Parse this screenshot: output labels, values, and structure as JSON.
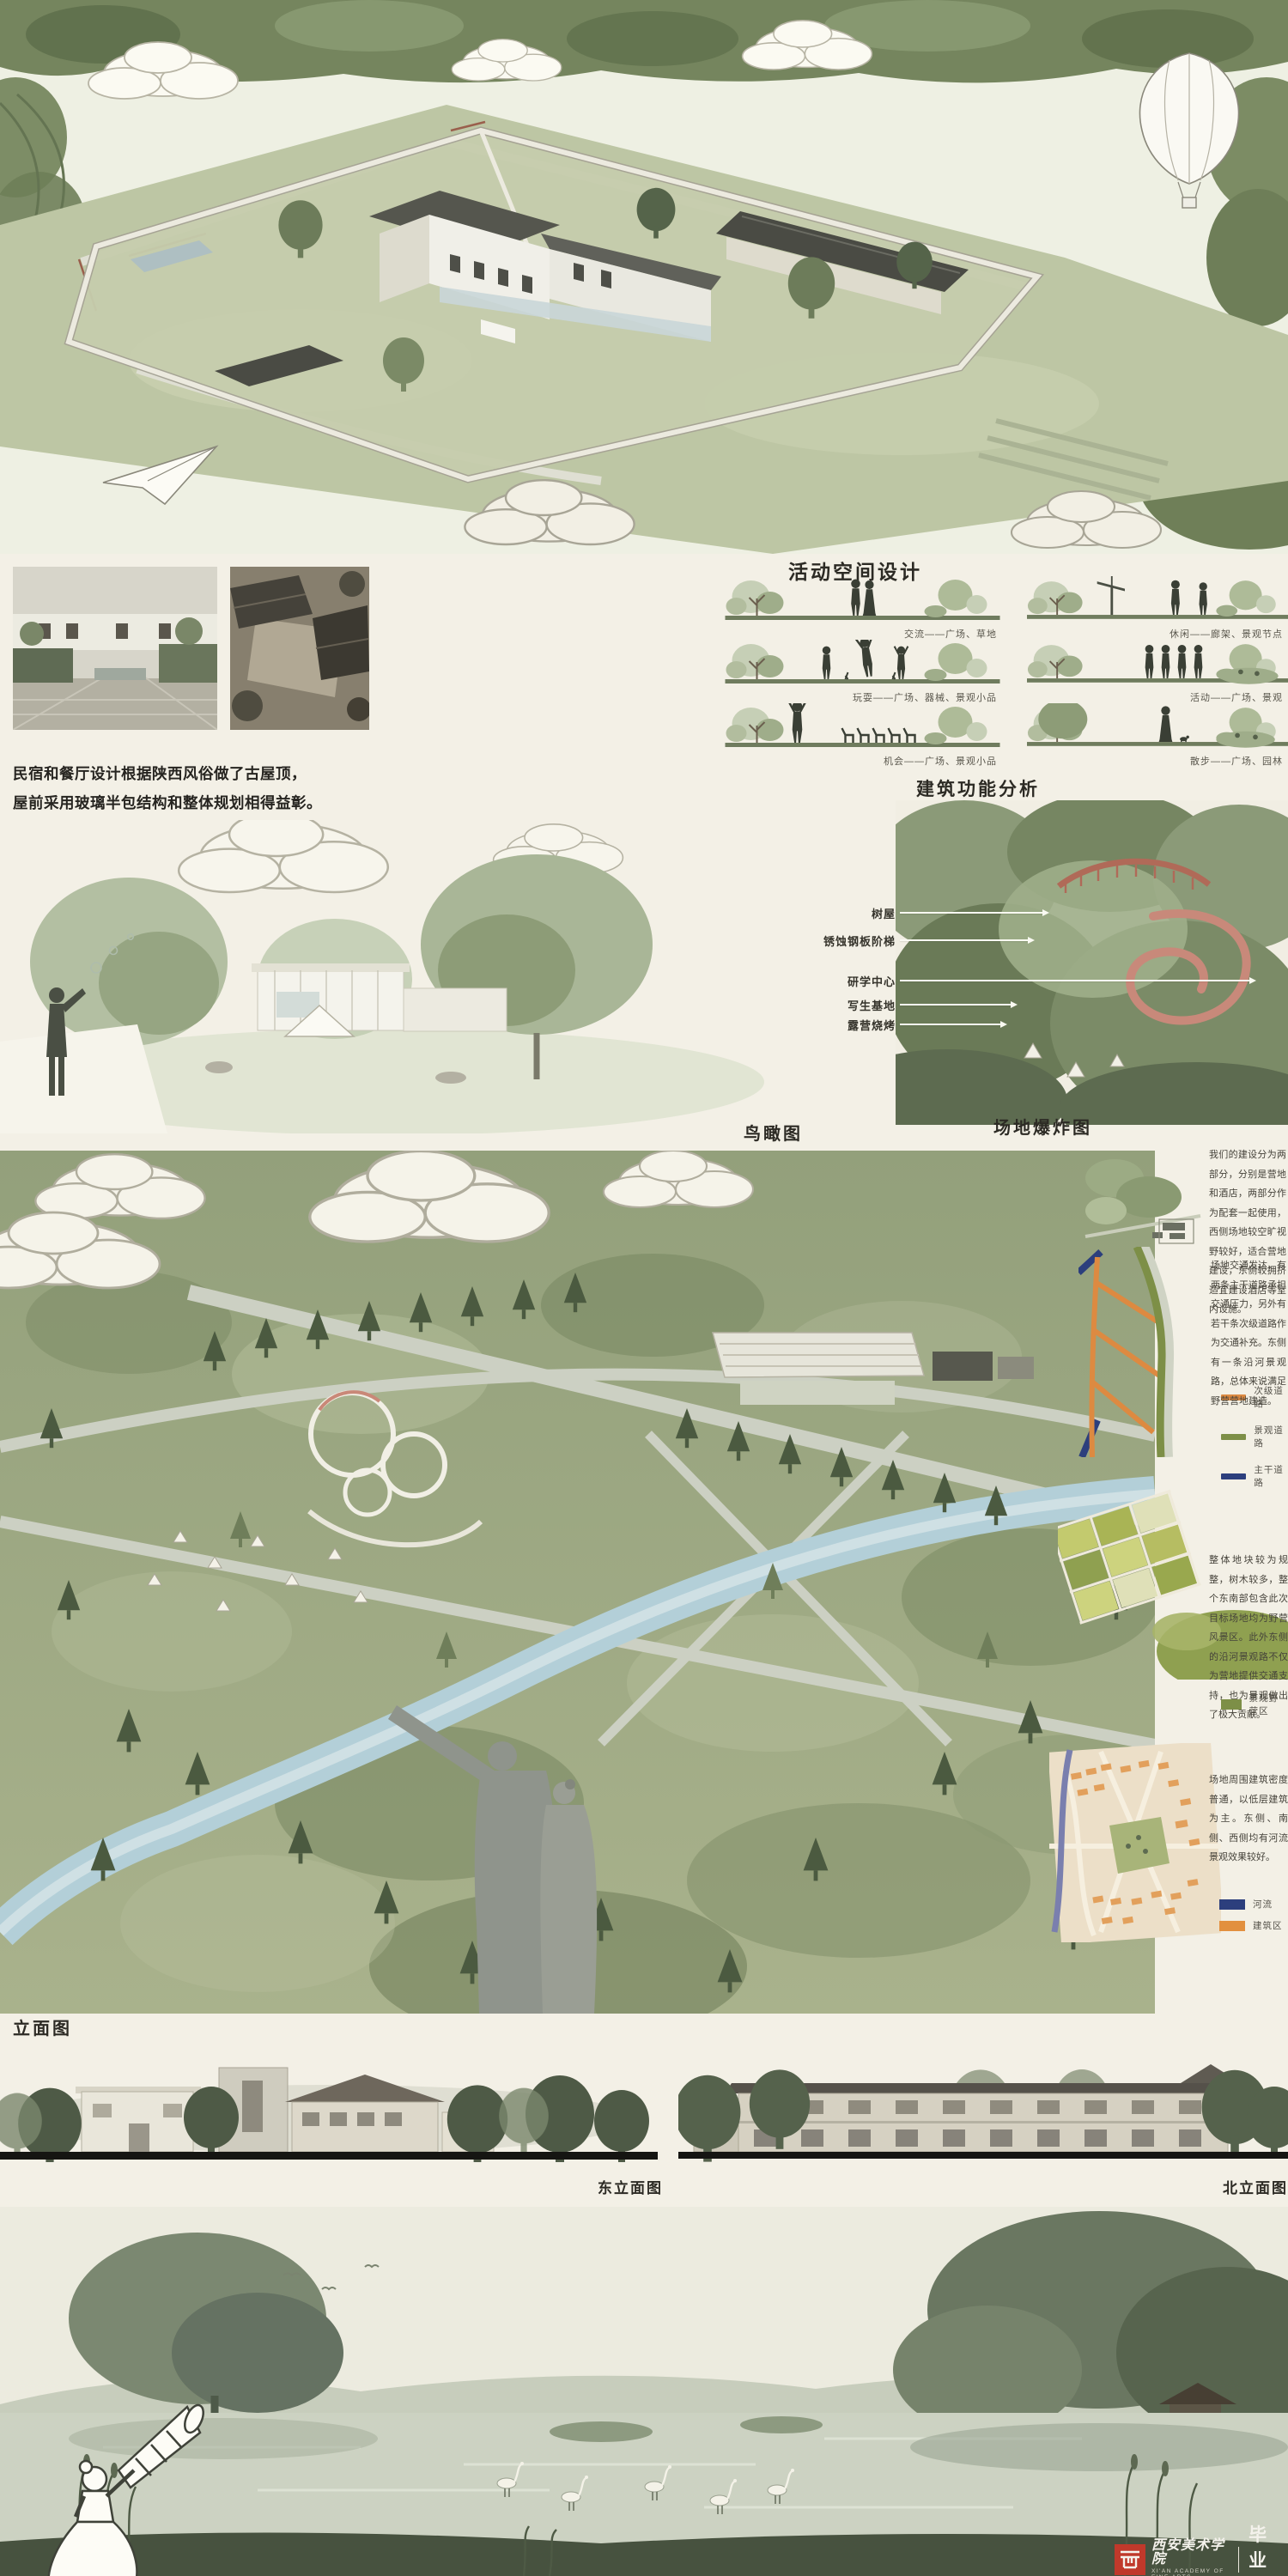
{
  "meta": {
    "page_bg": "#f3f0e6",
    "ground_bar_color": "#151512",
    "leader_line_color": "#fafaf2"
  },
  "intro": {
    "line1": "民宿和餐厅设计根据陕西风俗做了古屋顶，",
    "line2": "屋前采用玻璃半包结构和整体规划相得益彰。"
  },
  "activity": {
    "title": "活动空间设计",
    "items": [
      {
        "caption": "交流——广场、草地"
      },
      {
        "caption": "休闲——廊架、景观节点"
      },
      {
        "caption": "玩耍——广场、器械、景观小品"
      },
      {
        "caption": "活动——广场、景观"
      },
      {
        "caption": "机会——广场、景观小品"
      },
      {
        "caption": "散步——广场、园林"
      }
    ]
  },
  "function_analysis": {
    "title": "建筑功能分析",
    "labels": [
      "树屋",
      "锈蚀钢板阶梯",
      "研学中心",
      "写生基地",
      "露营烧烤"
    ]
  },
  "aerial": {
    "title": "鸟瞰图"
  },
  "site": {
    "title": "场地爆炸图",
    "blocks": [
      {
        "text": "我们的建设分为两部分，分别是营地和酒店，两部分作为配套一起使用，西侧场地较空旷视野较好，适合营地建设，东侧较拥挤适宜建设酒店等室内设施。"
      },
      {
        "text": "场地交通发达，有两条主干道路承担交通压力，另外有若干条次级道路作为交通补充。东侧有一条沿河景观路，总体来说满足野营营地建造。"
      },
      {
        "text": "整体地块较为规整，树木较多，整个东南部包含此次目标场地均为野营风景区。此外东侧的沿河景观路不仅为营地提供交通支持，也为景观做出了极大贡献。"
      },
      {
        "text": "场地周围建筑密度普通，以低层建筑为主。东侧、南侧、西侧均有河流景观效果较好。"
      }
    ],
    "road_legend": [
      {
        "label": "次级道路",
        "color": "#dd8a41"
      },
      {
        "label": "景观道路",
        "color": "#7d8f47"
      },
      {
        "label": "主干道路",
        "color": "#2c3f7d"
      }
    ],
    "farm_legend": [
      {
        "label": "景观野营区",
        "color": "#7d8f47"
      }
    ],
    "map_legend": [
      {
        "label": "河流",
        "color": "#2c3f7d"
      },
      {
        "label": "建筑区",
        "color": "#e2903f"
      }
    ]
  },
  "elevations": {
    "title": "立面图",
    "east_caption": "东立面图",
    "north_caption": "北立面图"
  },
  "watermark": {
    "academy_cn": "西安美术学院",
    "academy_en": "XI'AN ACADEMY OF FINE ARTS",
    "exhibition": "毕业展",
    "url": "xafa.meishu.org.cn",
    "seal_color": "#c0392b"
  }
}
